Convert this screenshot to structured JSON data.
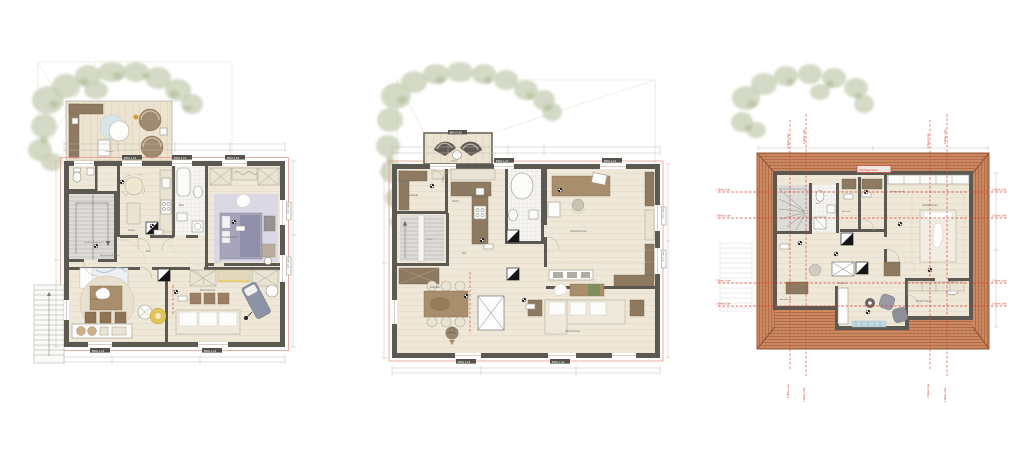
{
  "annotations": {
    "meter_line_1": "1 Meter Linie",
    "meter_line_2": "2 Meter Linie",
    "attic_badge": "Dachgeschoss",
    "stair_note": "14 Stg.",
    "window_label_a": "BRH 1,24",
    "window_label_b": "BRH 1,13",
    "window_label_c": "BRH 1,04",
    "window_label_d": "BRH 0,90"
  },
  "plan1": {
    "rooms": {
      "terrasse": "Terrasse",
      "kueche": "Küche",
      "bad": "Bad",
      "schlafzimmer": "Schlafzimmer",
      "kinderzimmer": "Kinderzimmer",
      "wohnzimmer": "Wohnzimmer",
      "flur": "Flur",
      "eingang1": "Eingang Wohnung 1",
      "eingang2": "Eingang Wohnung 2"
    }
  },
  "plan2": {
    "rooms": {
      "balkon": "Balkon",
      "ankleide": "Ankleide",
      "kueche": "Küche",
      "bad": "Bad",
      "arbeitszimmer": "Arbeitszimmer",
      "essplatz": "Essplatz",
      "wohnzimmer": "Wohnzimmer",
      "flur": "Flur"
    }
  },
  "plan3": {
    "rooms": {
      "bad": "Bad",
      "ankleide": "Ankleide",
      "schlafzimmer": "Schlafzimmer",
      "galerie": "Galerie",
      "kinderzimmer": "Kinderzimmer",
      "abstellraum": "Abstellraum",
      "kleiderschrank": "Kleiderschrank"
    }
  },
  "colors": {
    "wall": "#5c5852",
    "floor": "#efe8d9",
    "roof_tile": "#cd8a63",
    "red_line": "#cf4433",
    "tree": "#c9d1b6",
    "lavender": "#d9d8e4",
    "wood": "#8d7a61"
  }
}
